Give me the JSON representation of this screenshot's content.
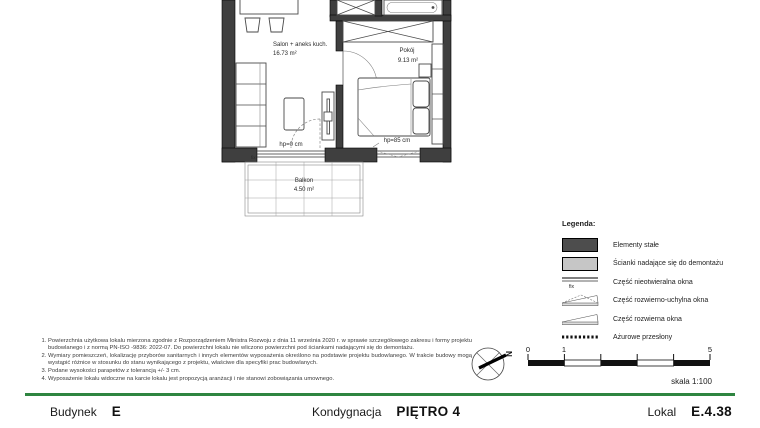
{
  "plan": {
    "salon_name": "Salon + aneks kuch.",
    "salon_area": "16.73 m²",
    "pokoj_name": "Pokój",
    "pokoj_area": "9.13 m²",
    "balkon_name": "Balkon",
    "balkon_area": "4.50 m²",
    "hp_balcony": "hp=0 cm",
    "hp_bedroom": "hp=85 cm",
    "fix_label": "fix"
  },
  "legend": {
    "title": "Legenda:",
    "colors": {
      "solid_wall": "#4d4d4d",
      "removable_wall": "#c6c6c6"
    },
    "items": [
      {
        "label": "Elementy stałe"
      },
      {
        "label": "Ścianki nadające się do demontażu"
      },
      {
        "label": "Część nieotwieralna okna",
        "fix_label": "fix"
      },
      {
        "label": "Część rozwierno-uchylna okna"
      },
      {
        "label": "Część rozwierna okna"
      },
      {
        "label": "Ażurowe przesłony"
      }
    ]
  },
  "notes": [
    "Powierzchnia użytkowa lokalu mierzona zgodnie z Rozporządzeniem Ministra Rozwoju z dnia 11 września 2020 r. w sprawie szczegółowego zakresu i formy projektu budowlanego i z normą PN-ISO -9836: 2022-07. Do powierzchni lokalu nie wliczono powierzchni pod ściankami nadającymi się do demontażu.",
    "Wymiary pomieszczeń, lokalizację przyborów sanitarnych i innych elementów wyposażenia określono na podstawie projektu budowlanego. W trakcie budowy mogą wystąpić różnice w stosunku do stanu wynikającego z projektu, właściwe dla specyfiki prac budowlanych.",
    "Podane wysokości parapetów z tolerancją +/- 3 cm.",
    "Wyposażenie lokalu widoczne na karcie lokalu jest propozycją aranżacji i nie stanowi zobowiązania umownego."
  ],
  "north": {
    "label": "N"
  },
  "scale": {
    "ticks": [
      "0",
      "1",
      "5"
    ],
    "caption": "skala 1:100"
  },
  "footer": {
    "accent_color": "#2e8540",
    "building_label": "Budynek",
    "building_value": "E",
    "floor_label": "Kondygnacja",
    "floor_value": "PIĘTRO 4",
    "unit_label": "Lokal",
    "unit_value": "E.4.38"
  }
}
